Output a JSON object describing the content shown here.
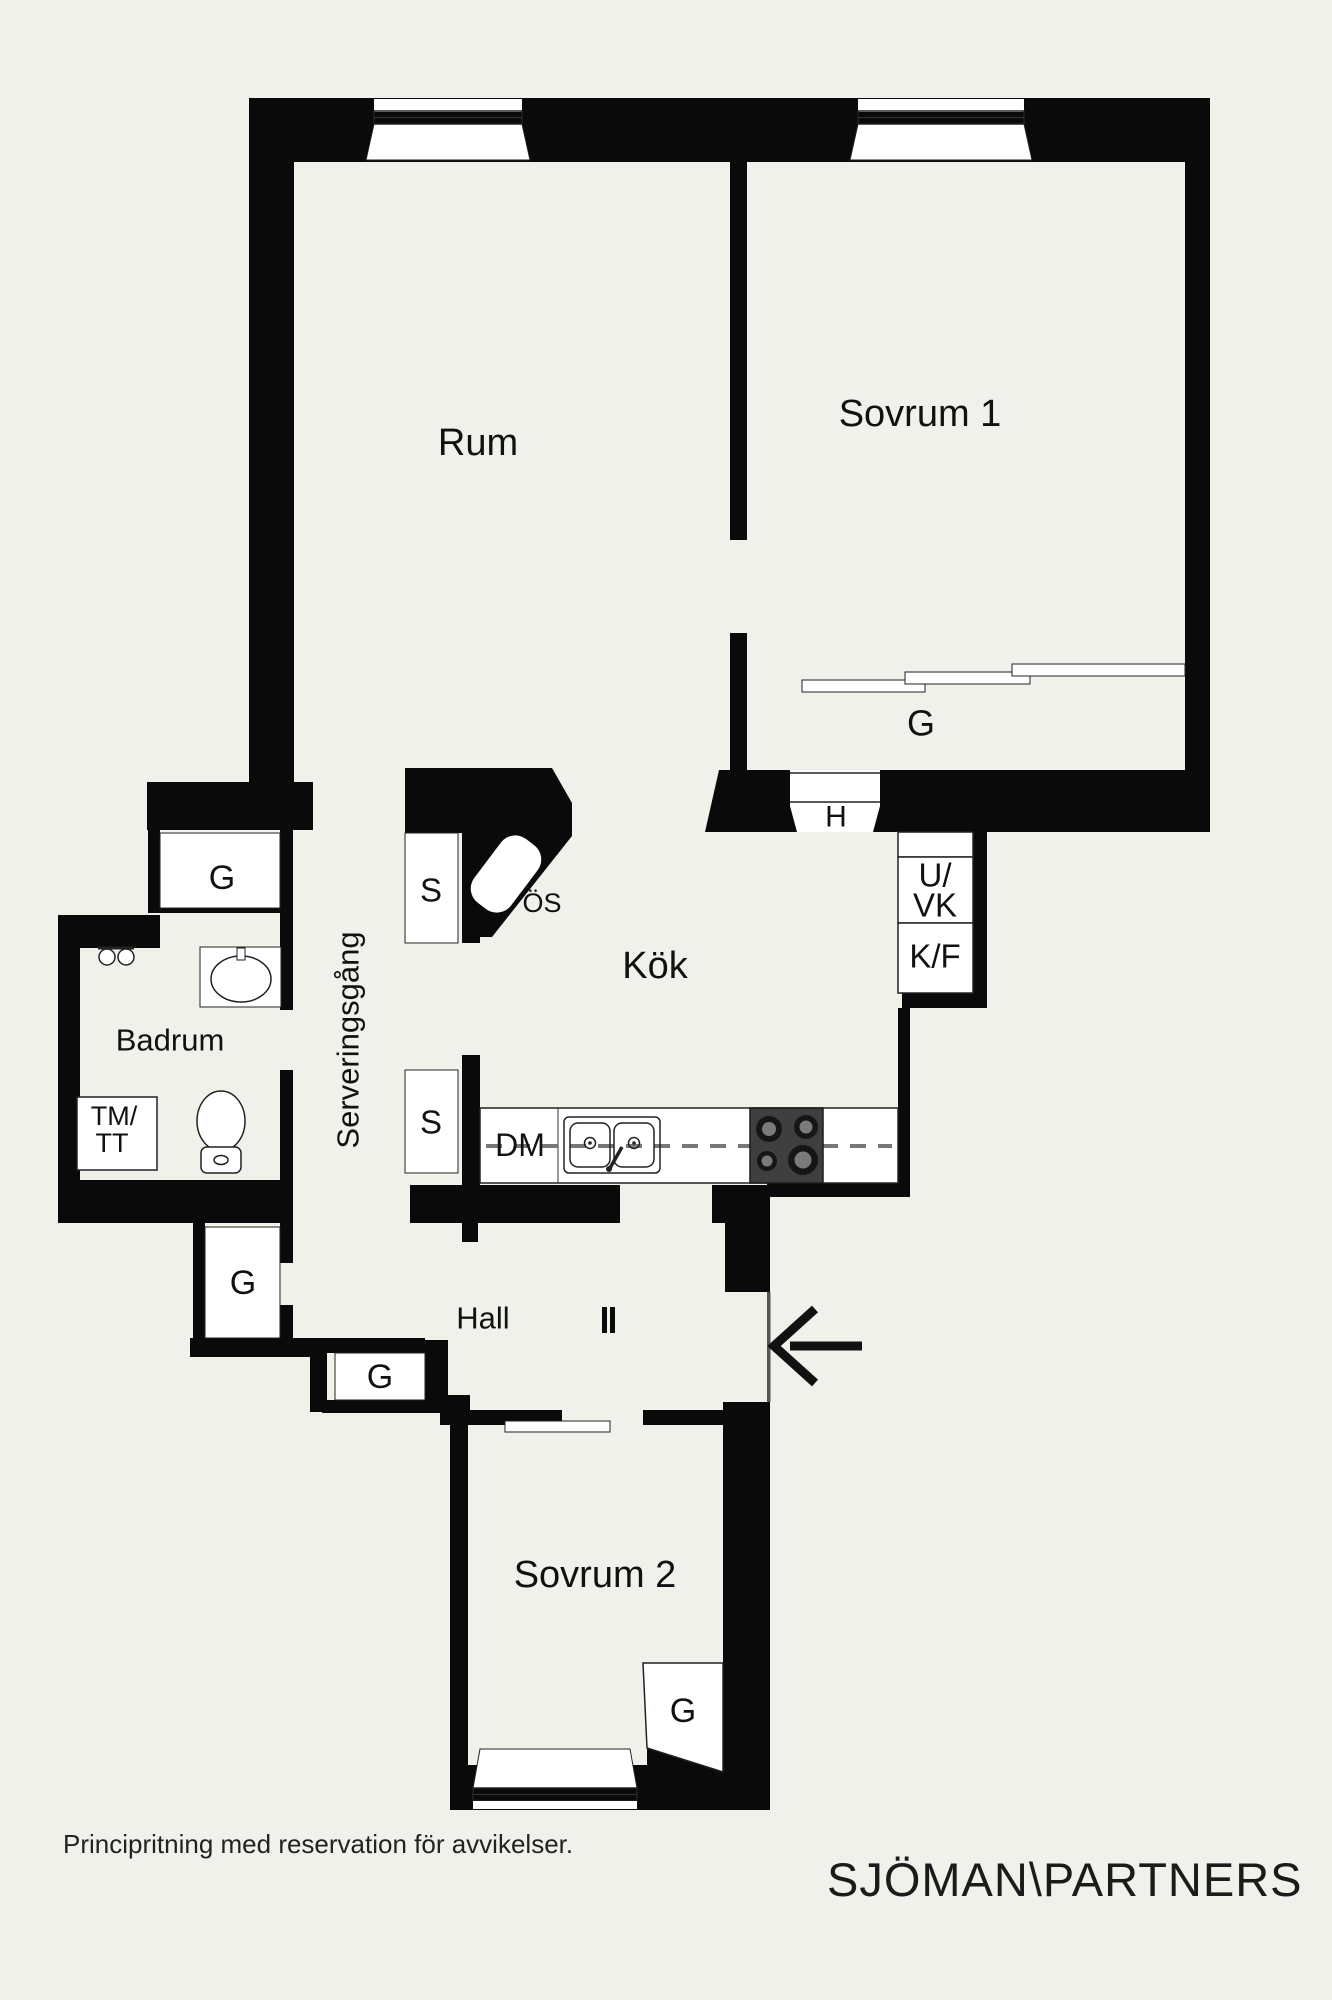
{
  "page": {
    "background": "#f1f1eb",
    "wall_color": "#0a0a0a",
    "disclaimer": "Principritning med reservation för avvikelser.",
    "brand": "SJÖMAN\\PARTNERS"
  },
  "rooms": {
    "rum": {
      "label": "Rum"
    },
    "sovrum1": {
      "label": "Sovrum 1"
    },
    "kok": {
      "label": "Kök"
    },
    "badrum": {
      "label": "Badrum"
    },
    "serveringsgang": {
      "label": "Serveringsgång"
    },
    "hall": {
      "label": "Hall"
    },
    "sovrum2": {
      "label": "Sovrum 2"
    }
  },
  "labels": {
    "wardrobe": "G",
    "hatch": "H",
    "cabinet": "S",
    "fireplace": "ÖS",
    "dishwasher": "DM",
    "oven_line1": "U/",
    "oven_line2": "VK",
    "fridge_freezer": "K/F",
    "washer_line1": "TM/",
    "washer_line2": "TT"
  }
}
